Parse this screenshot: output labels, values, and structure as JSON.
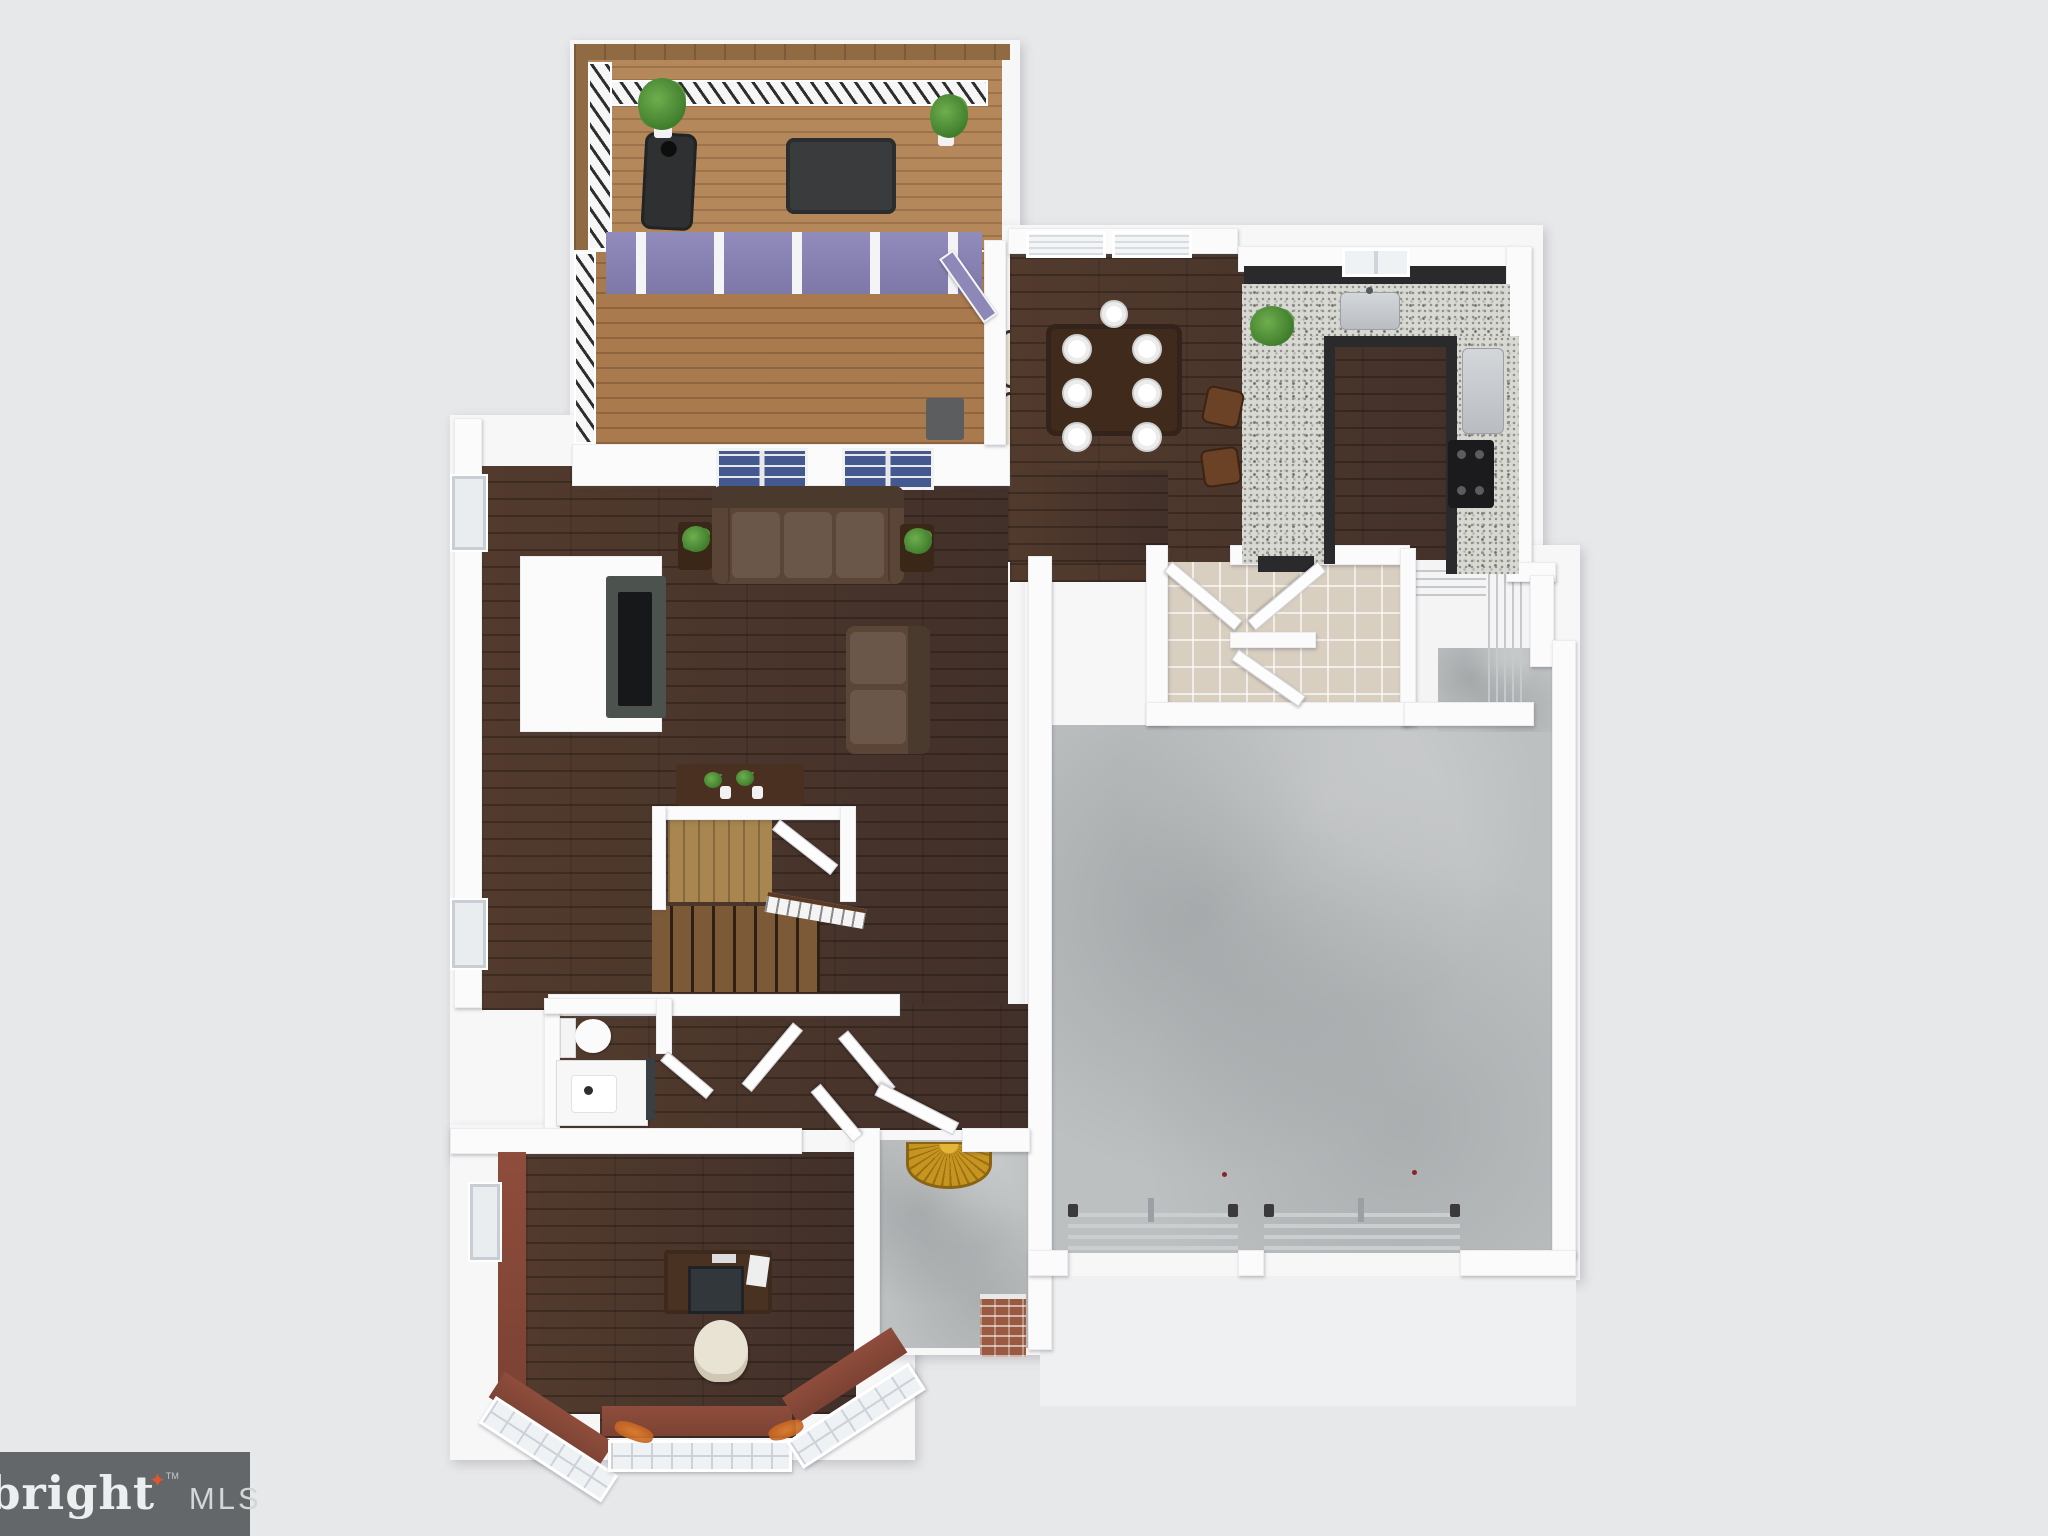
{
  "watermark": {
    "brand": "bright",
    "trademark": "TM",
    "suffix": "MLS",
    "star_glyph": "✦"
  },
  "scene": {
    "type": "3D rendered top-down floor plan of a house first floor",
    "rooms": [
      {
        "name": "deck",
        "floor": "light wood planks"
      },
      {
        "name": "sunroom",
        "floor": "medium wood planks"
      },
      {
        "name": "dining-area",
        "floor": "dark walnut wood"
      },
      {
        "name": "kitchen",
        "floor": "dark walnut wood",
        "counters": "granite with dark cabinets"
      },
      {
        "name": "living-room",
        "floor": "dark walnut wood"
      },
      {
        "name": "mudroom-laundry",
        "floor": "beige tile"
      },
      {
        "name": "pantry-closet",
        "feature": "wire shelving"
      },
      {
        "name": "staircase",
        "feature": "wood treads, white railing, under-stair closet"
      },
      {
        "name": "powder-room",
        "fixtures": "toilet, vanity sink"
      },
      {
        "name": "hallway-foyer",
        "floor": "dark walnut wood"
      },
      {
        "name": "office",
        "walls": "maroon red",
        "feature": "bay window"
      },
      {
        "name": "front-porch",
        "floor": "concrete",
        "feature": "sunburst doormat, brick column"
      },
      {
        "name": "garage",
        "floor": "concrete",
        "feature": "two overhead door tracks"
      }
    ],
    "furniture": [
      "bbq-grill",
      "deck-dining-table",
      "deck-chairs-x4",
      "potted-plants",
      "wicker-chairs-x2",
      "sectional-sofa",
      "loveseat",
      "tv-media-console",
      "side-tables-with-plants",
      "console-table",
      "dining-table-with-plates",
      "dining-chairs-x6",
      "kitchen-sink",
      "refrigerator",
      "range",
      "bar-stools-x2",
      "toilet",
      "bathroom-vanity",
      "desk-with-monitor",
      "office-chair"
    ]
  },
  "palette": {
    "bg": "#e7e8ea",
    "wall": "#fbfbfc",
    "wood_dark": "#4a3428",
    "deck_wood": "#b5885c",
    "sunroom_wood": "#a87a4e",
    "granite": "#d9d9d3",
    "cabinet_dark": "#2a2a2c",
    "concrete": "#bdc0c1",
    "tile": "#d8cfc0",
    "glass_purple": "#8d88b8",
    "office_wall": "#8f4d3c",
    "sofa_brown": "#5a4536",
    "cushion_cream": "#e9e3d3",
    "plant_green": "#3f7d2c",
    "mat_gold": "#c6951f",
    "brick": "#9a5a42",
    "logo_bg": "#63676a",
    "logo_text": "#eceff0",
    "logo_muted": "#d3d7d8",
    "logo_star": "#e2552e"
  }
}
